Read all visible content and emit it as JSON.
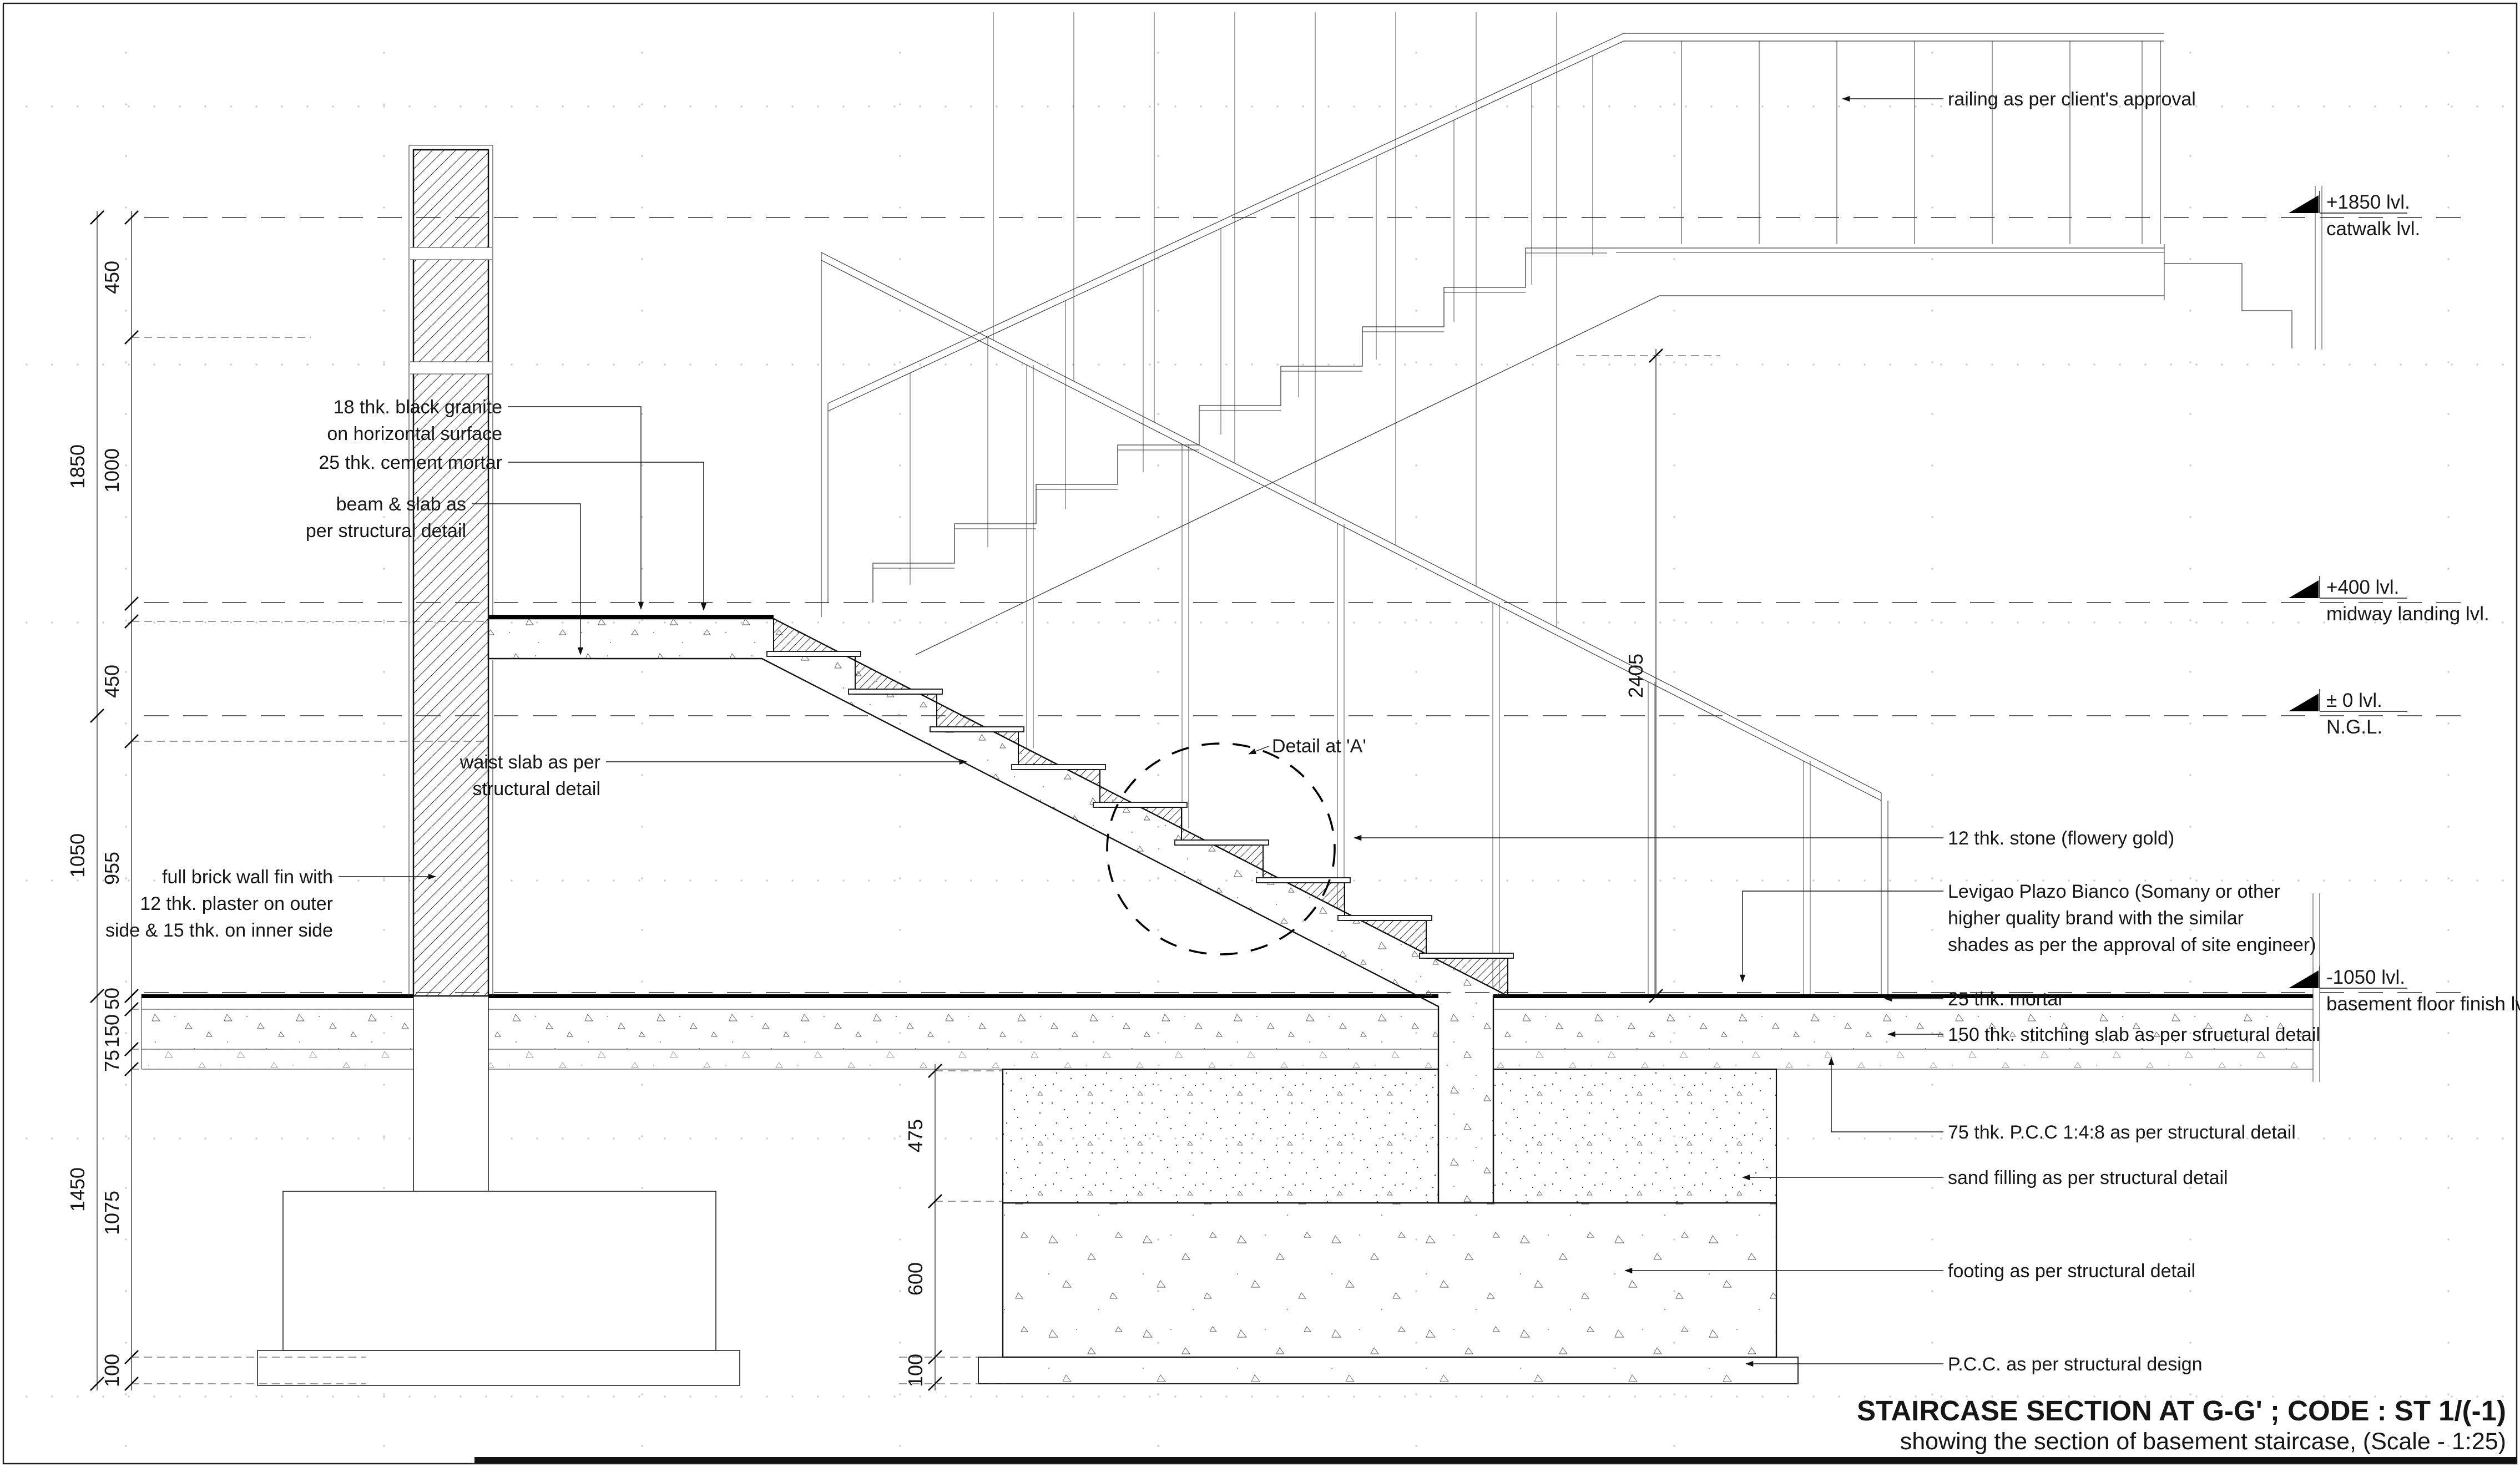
{
  "drawing": {
    "title": "STAIRCASE SECTION AT G-G' ; CODE : ST 1/(-1)",
    "subtitle": "showing the section of basement staircase, (Scale - 1:25)",
    "detail_callout": "Detail at 'A'"
  },
  "levels": [
    {
      "value": "+1850 lvl.",
      "name": "catwalk lvl."
    },
    {
      "value": "+400 lvl.",
      "name": "midway landing lvl."
    },
    {
      "value": "± 0 lvl.",
      "name": "N.G.L."
    },
    {
      "value": "-1050 lvl.",
      "name": "basement floor finish lvl."
    }
  ],
  "annotations_left": {
    "granite_lines": [
      "18 thk. black granite",
      "on horizontal surface"
    ],
    "mortar": "25 thk. cement mortar",
    "beam_lines": [
      "beam & slab as",
      "per  structural detail"
    ],
    "waist_lines": [
      "waist slab as per",
      "structural detail"
    ],
    "brick_lines": [
      "full brick wall fin with",
      "12 thk. plaster on outer",
      "side & 15 thk. on inner side"
    ]
  },
  "annotations_right": {
    "railing": "railing as per client's approval",
    "stone": "12 thk. stone (flowery gold)",
    "levigao_lines": [
      "Levigao Plazo Bianco (Somany or other",
      "higher quality brand with the similar",
      "shades as per the approval of site engineer)"
    ],
    "mortar": "25 thk. mortar",
    "stitching_slab": "150 thk. stitching slab as per structural detail",
    "pcc_75": "75 thk. P.C.C 1:4:8 as per structural detail",
    "sand_filling": "sand filling as per structural detail",
    "footing": "footing as per structural detail",
    "pcc_design": "P.C.C. as per structural design"
  },
  "dimensions": {
    "left_outer": [
      "1850",
      "1050",
      "1450"
    ],
    "left_inner": [
      "450",
      "1000",
      "450",
      "955",
      "50",
      "150",
      "75",
      "1075",
      "100"
    ],
    "middle": [
      "475",
      "600",
      "100"
    ],
    "stair_height": "2405"
  }
}
